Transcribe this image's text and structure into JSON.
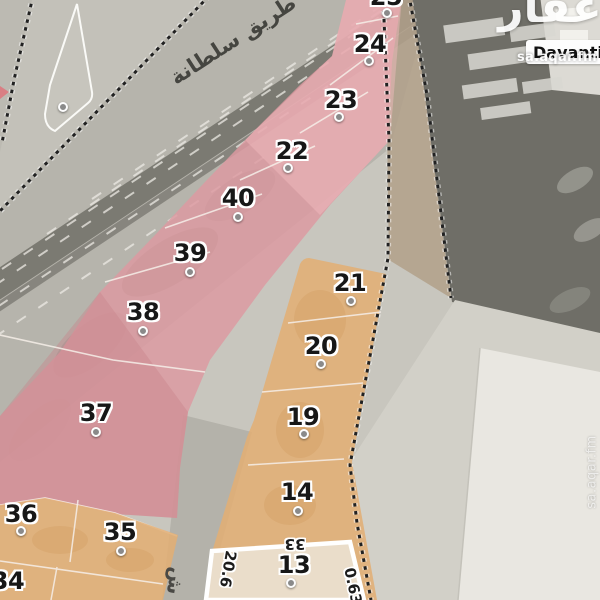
{
  "branding": {
    "logo_text": "عقار",
    "watermark_top": "sa.aqar.fm",
    "watermark_side": "sa.aqar.fm"
  },
  "map": {
    "road_name": "طريق سلطانة",
    "street_label": "ش",
    "poi_label": "Davanti"
  },
  "plots": {
    "pink": [
      {
        "number": "25"
      },
      {
        "number": "24"
      },
      {
        "number": "23"
      },
      {
        "number": "22"
      },
      {
        "number": "40"
      },
      {
        "number": "39"
      },
      {
        "number": "38"
      },
      {
        "number": "37"
      }
    ],
    "orange": [
      {
        "number": "21"
      },
      {
        "number": "20"
      },
      {
        "number": "19"
      },
      {
        "number": "14"
      },
      {
        "number": "36"
      },
      {
        "number": "35"
      },
      {
        "number": "34"
      }
    ],
    "selected": {
      "number": "13",
      "dim_top": "33",
      "dim_left": "20.6",
      "dim_right": "0.63"
    }
  },
  "colors": {
    "plot_pink": "#dd9aa1",
    "plot_pink_shade": "#c9818a",
    "plot_pink_light": "#f3bcc0",
    "plot_orange": "#e3ae73",
    "selected_fill": "#eadfcf",
    "selected_border": "#ffffff",
    "boundary": "#212121"
  }
}
